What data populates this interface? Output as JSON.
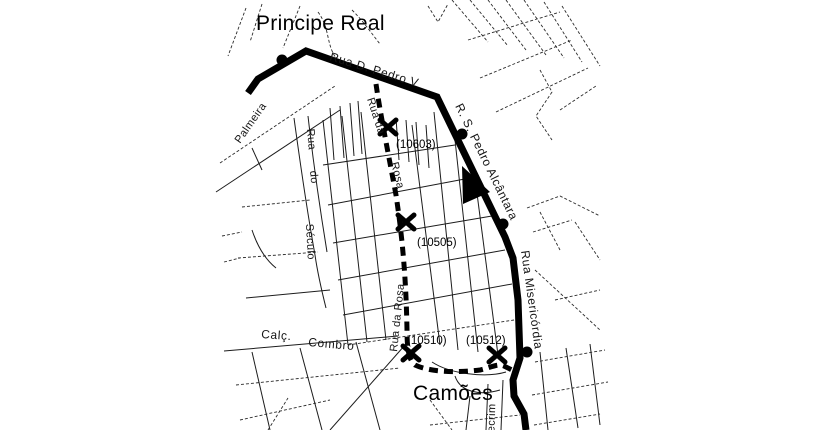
{
  "map": {
    "colors": {
      "background": "#ffffff",
      "ink": "#000000"
    },
    "area_labels": [
      {
        "id": "principe-real",
        "text": "Principe Real"
      },
      {
        "id": "camoes",
        "text": "Camões"
      }
    ],
    "street_labels": [
      {
        "id": "rua-d-pedro-v",
        "text": "Rua  D. Pedro  V"
      },
      {
        "id": "r-s-pedro-alcantara",
        "text": "R. S. Pedro Alcântara"
      },
      {
        "id": "rua-misericordia",
        "text": "Rua Misericórdia"
      },
      {
        "id": "rua-da-rosa-upper-a",
        "text": "Rua da"
      },
      {
        "id": "rua-da-rosa-upper-b",
        "text": "Rosa"
      },
      {
        "id": "rua-da-rosa-lower",
        "text": "Rua da Rosa"
      },
      {
        "id": "rua-do-seculo-a",
        "text": "Rua"
      },
      {
        "id": "rua-do-seculo-b",
        "text": "do"
      },
      {
        "id": "rua-do-seculo-c",
        "text": "Século"
      },
      {
        "id": "palmeira",
        "text": "Palmeira"
      },
      {
        "id": "calcada",
        "text": "Calç."
      },
      {
        "id": "combro",
        "text": "Combro"
      },
      {
        "id": "alecrim",
        "text": "Alecrim"
      }
    ],
    "stops": [
      {
        "id": "10603",
        "label": "(10603)"
      },
      {
        "id": "10505",
        "label": "(10505)"
      },
      {
        "id": "10510",
        "label": "(10510)"
      },
      {
        "id": "10512",
        "label": "(10512)"
      }
    ]
  }
}
